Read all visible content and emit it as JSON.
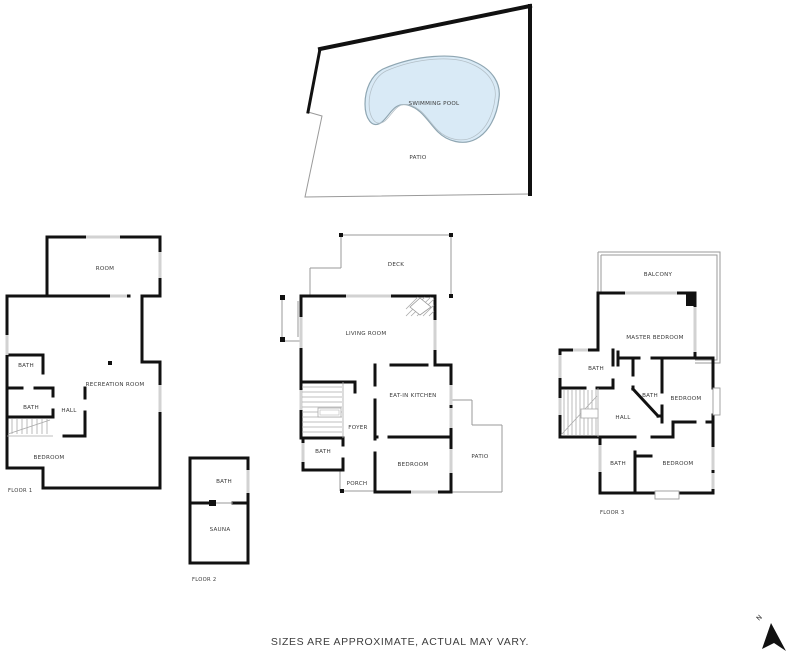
{
  "pool_area": {
    "swimming_pool": "SWIMMING POOL",
    "patio": "PATIO"
  },
  "floor1": {
    "label": "FLOOR 1",
    "room": "ROOM",
    "recreation_room": "RECREATION ROOM",
    "bath_upper": "BATH",
    "bath_lower": "BATH",
    "hall": "HALL",
    "bedroom": "BEDROOM"
  },
  "floor2": {
    "label": "FLOOR 2",
    "deck": "DECK",
    "living_room": "LIVING ROOM",
    "eat_in_kitchen": "EAT-IN KITCHEN",
    "foyer": "FOYER",
    "bath": "BATH",
    "porch": "PORCH",
    "bedroom": "BEDROOM",
    "patio": "PATIO",
    "sauna": "SAUNA",
    "sauna_bath": "BATH"
  },
  "floor3": {
    "label": "FLOOR 3",
    "balcony": "BALCONY",
    "master_bedroom": "MASTER BEDROOM",
    "bath_top": "BATH",
    "bath_middle": "BATH",
    "bath_lower": "BATH",
    "bedroom_middle": "BEDROOM",
    "bedroom_lower": "BEDROOM",
    "hall": "HALL"
  },
  "compass": {
    "north": "N"
  },
  "footer": {
    "disclaimer": "SIZES ARE APPROXIMATE, ACTUAL MAY VARY."
  },
  "colors": {
    "wall": "#111111",
    "window": "#d2d2d2",
    "thin_line": "#9a9a9a",
    "pool_fill": "#d9eaf6",
    "pool_stroke": "#8fa6b2",
    "text": "#3a3a3a"
  }
}
